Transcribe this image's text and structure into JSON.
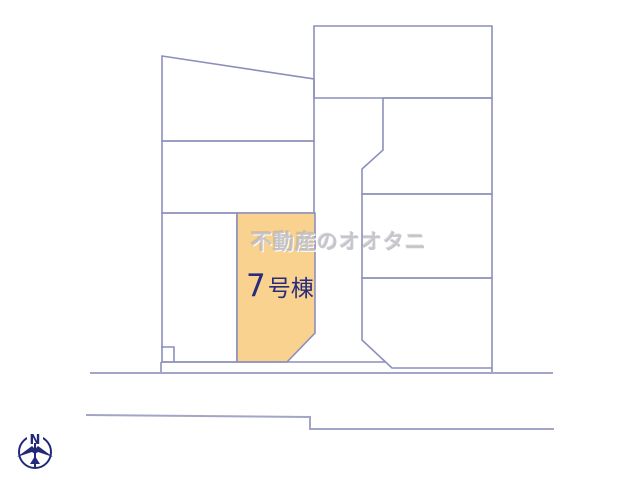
{
  "map": {
    "watermark": "不動産のオオタニ",
    "highlighted_parcel": {
      "number": "7",
      "suffix": "号棟"
    },
    "compass": {
      "north_label": "N"
    }
  },
  "colors": {
    "highlight_fill": "#F8D28E",
    "parcel_line": "#8B8FBA",
    "far_road_line": "#A2A5C6",
    "label_navy": "#272C7C",
    "compass_navy": "#232979",
    "watermark_gray": "#BDBDC4",
    "background": "#FFFFFF"
  }
}
